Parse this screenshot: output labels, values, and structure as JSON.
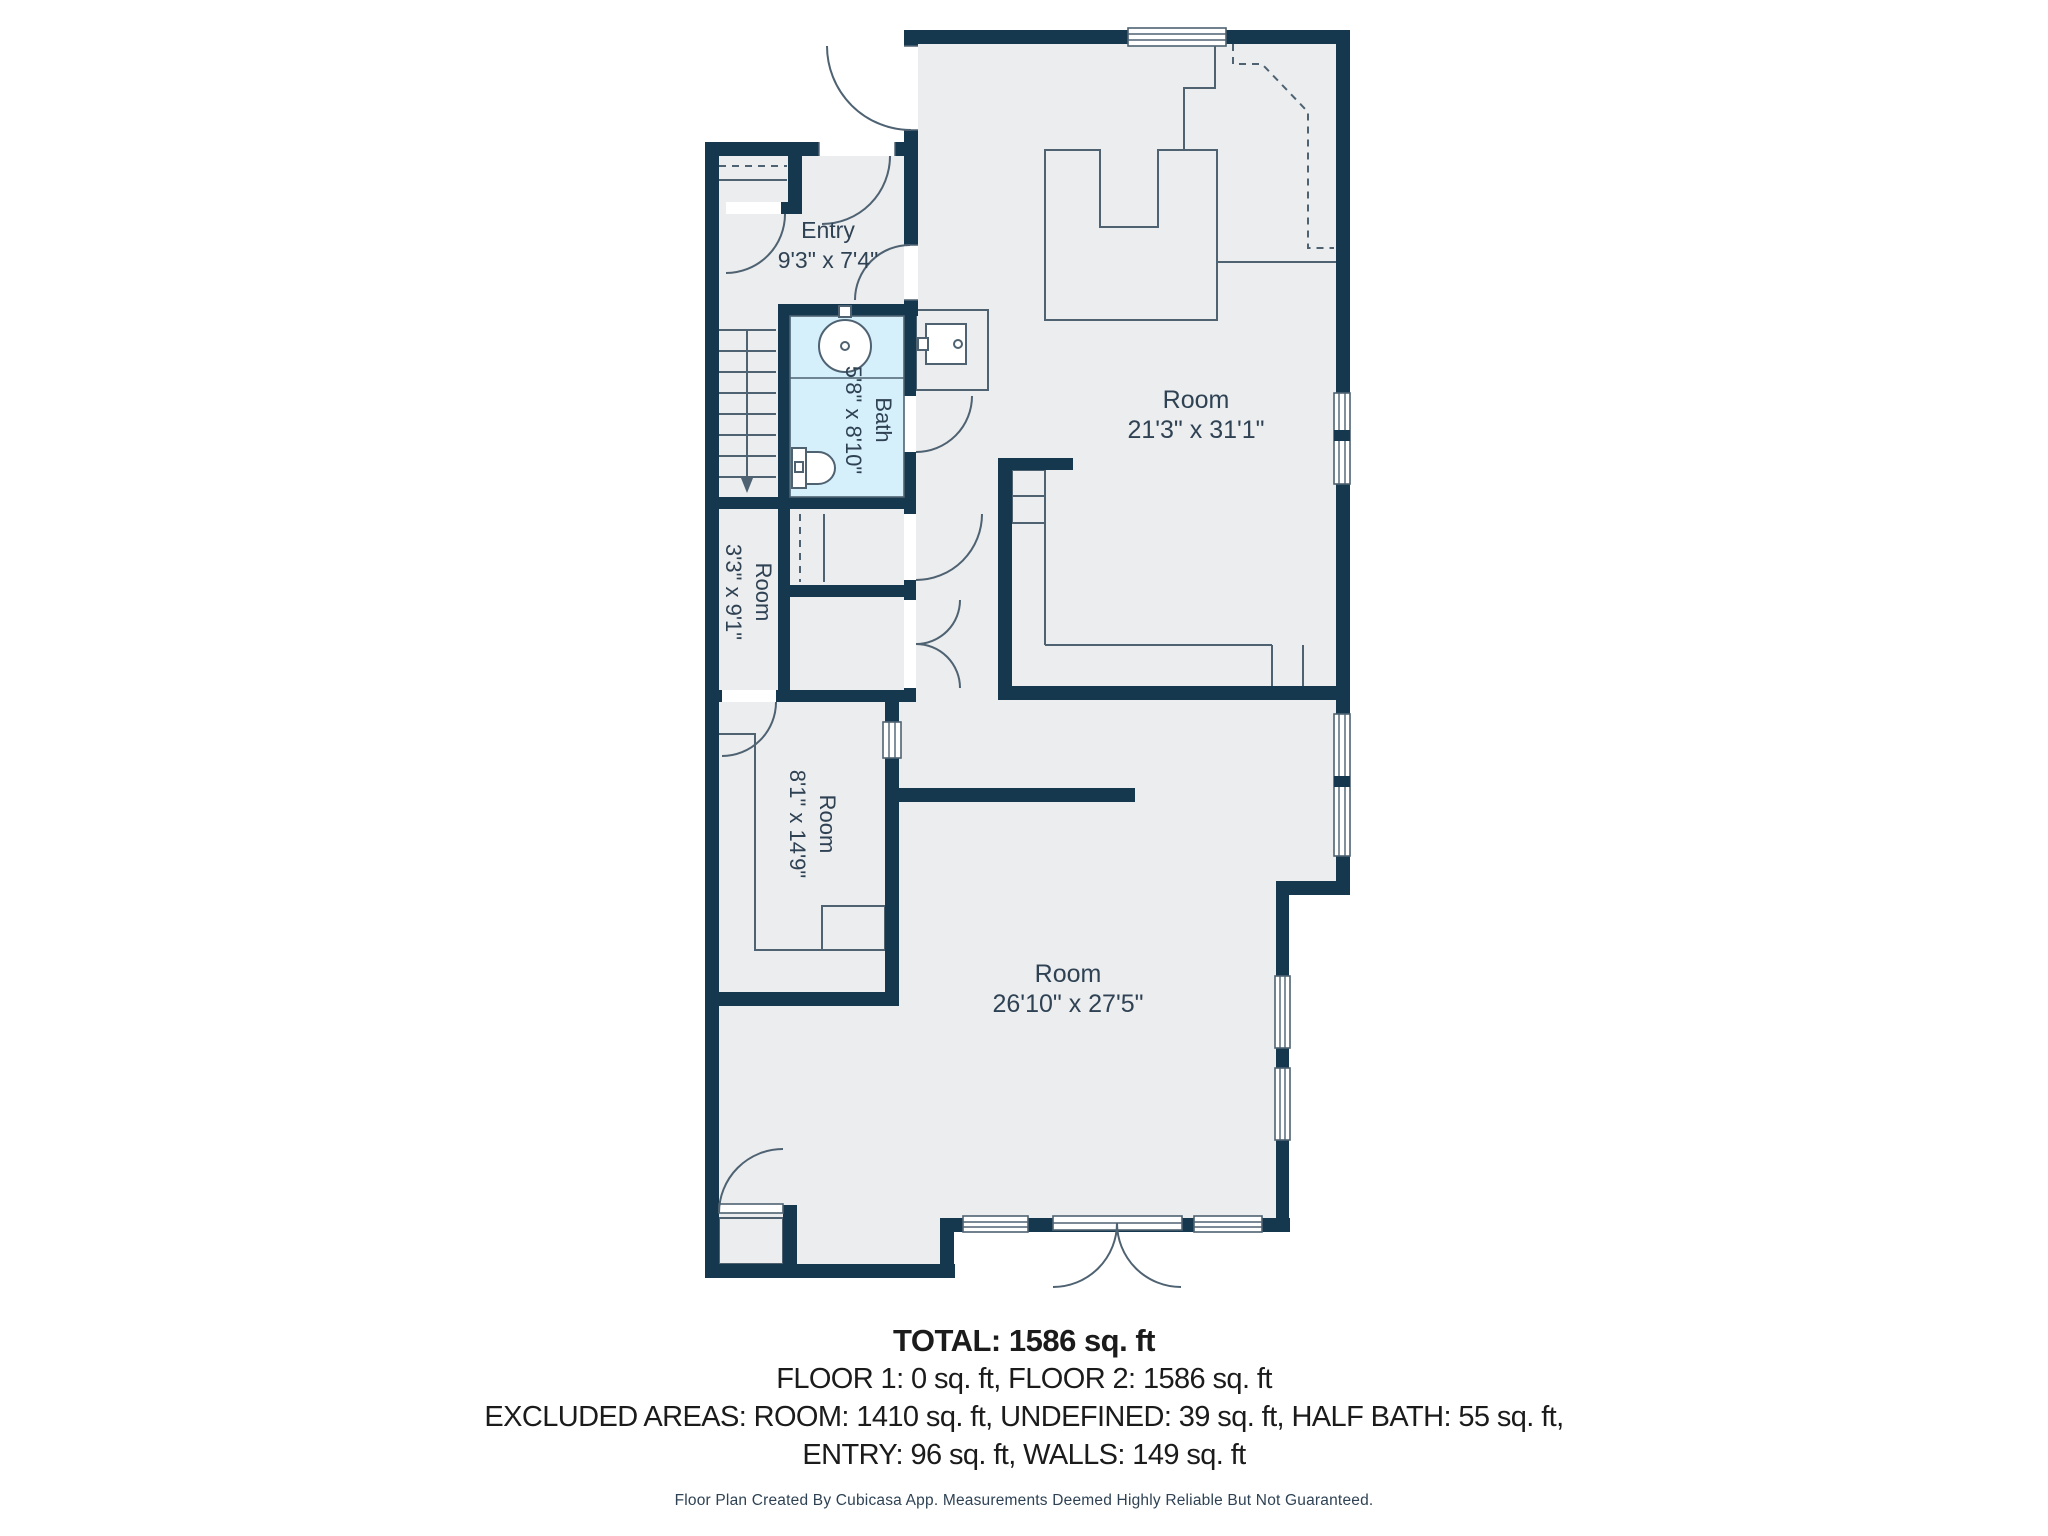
{
  "plan": {
    "colors": {
      "wall": "#16384F",
      "floor": "#ECEDEF",
      "bath_fill": "#D5EFFB",
      "line": "#4E6272"
    },
    "rooms": [
      {
        "name": "Entry",
        "dims": "9'3\" x 7'4\""
      },
      {
        "name": "Bath",
        "dims": "5'8\" x 8'10\""
      },
      {
        "name": "Room",
        "dims": "3'3\" x 9'1\""
      },
      {
        "name": "Room",
        "dims": "21'3\" x 31'1\""
      },
      {
        "name": "Room",
        "dims": "8'1\" x 14'9\""
      },
      {
        "name": "Room",
        "dims": "26'10\" x 27'5\""
      }
    ]
  },
  "summary": {
    "total": "TOTAL: 1586 sq. ft",
    "floors": "FLOOR 1: 0 sq. ft, FLOOR 2: 1586 sq. ft",
    "excluded_1": "EXCLUDED AREAS: ROOM: 1410 sq. ft, UNDEFINED: 39 sq. ft, HALF BATH: 55 sq. ft,",
    "excluded_2": "ENTRY: 96 sq. ft, WALLS: 149 sq. ft"
  },
  "footer": "Floor Plan Created By Cubicasa App. Measurements Deemed Highly Reliable But Not Guaranteed."
}
